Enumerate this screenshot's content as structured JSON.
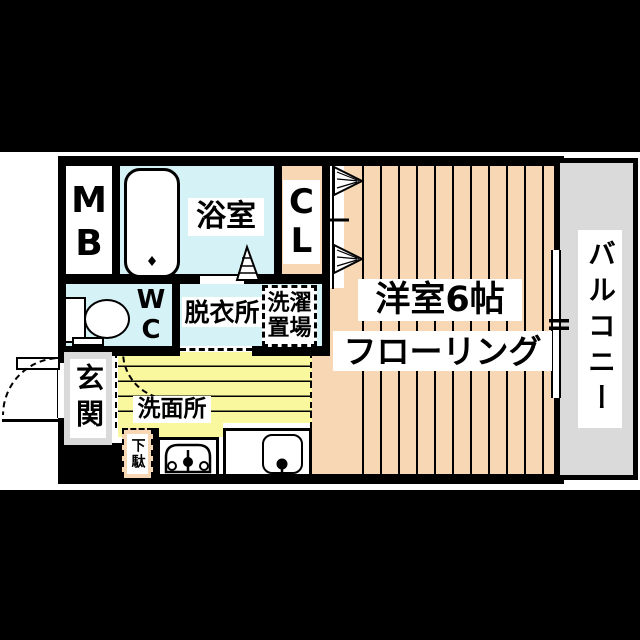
{
  "floorplan": {
    "rooms": {
      "meter_box": {
        "chars": [
          "M",
          "B"
        ]
      },
      "bathroom": {
        "label": "浴室"
      },
      "closet": {
        "chars": [
          "C",
          "L"
        ]
      },
      "toilet": {
        "chars": [
          "W",
          "C"
        ]
      },
      "dressing_room": {
        "label": "脱衣所"
      },
      "laundry_area": {
        "lines": [
          "洗濯",
          "置場"
        ]
      },
      "western_room": {
        "label": "洋室6帖",
        "sublabel": "フローリング"
      },
      "balcony": {
        "label": "バルコニー"
      },
      "entrance": {
        "label": "玄関"
      },
      "washroom": {
        "label": "洗面所"
      },
      "shoe_cabinet": {
        "label": "下駄"
      }
    },
    "colors": {
      "wood_floor": "#F8D8B4",
      "wet_area_blue": "#D5F2F6",
      "washroom_yellow": "#FAF89F",
      "balcony_gray": "#DADADA",
      "wall_black": "#000000",
      "paper_white": "#FFFFFF",
      "letterbox_black": "#000000"
    },
    "icons": {
      "bathtub": "bathtub-outline",
      "toilet": "toilet-tank-and-bowl",
      "sink": "washbasin-with-faucet",
      "washer_space": "washing-machine-outline-with-faucet",
      "closet_door": "bifold-door-triangles",
      "bath_door": "folding-door-triangle",
      "entrance_door": "door-leaf-with-swing-arc",
      "interior_door": "swing-arc",
      "window": "sliding-window-double-line"
    }
  }
}
